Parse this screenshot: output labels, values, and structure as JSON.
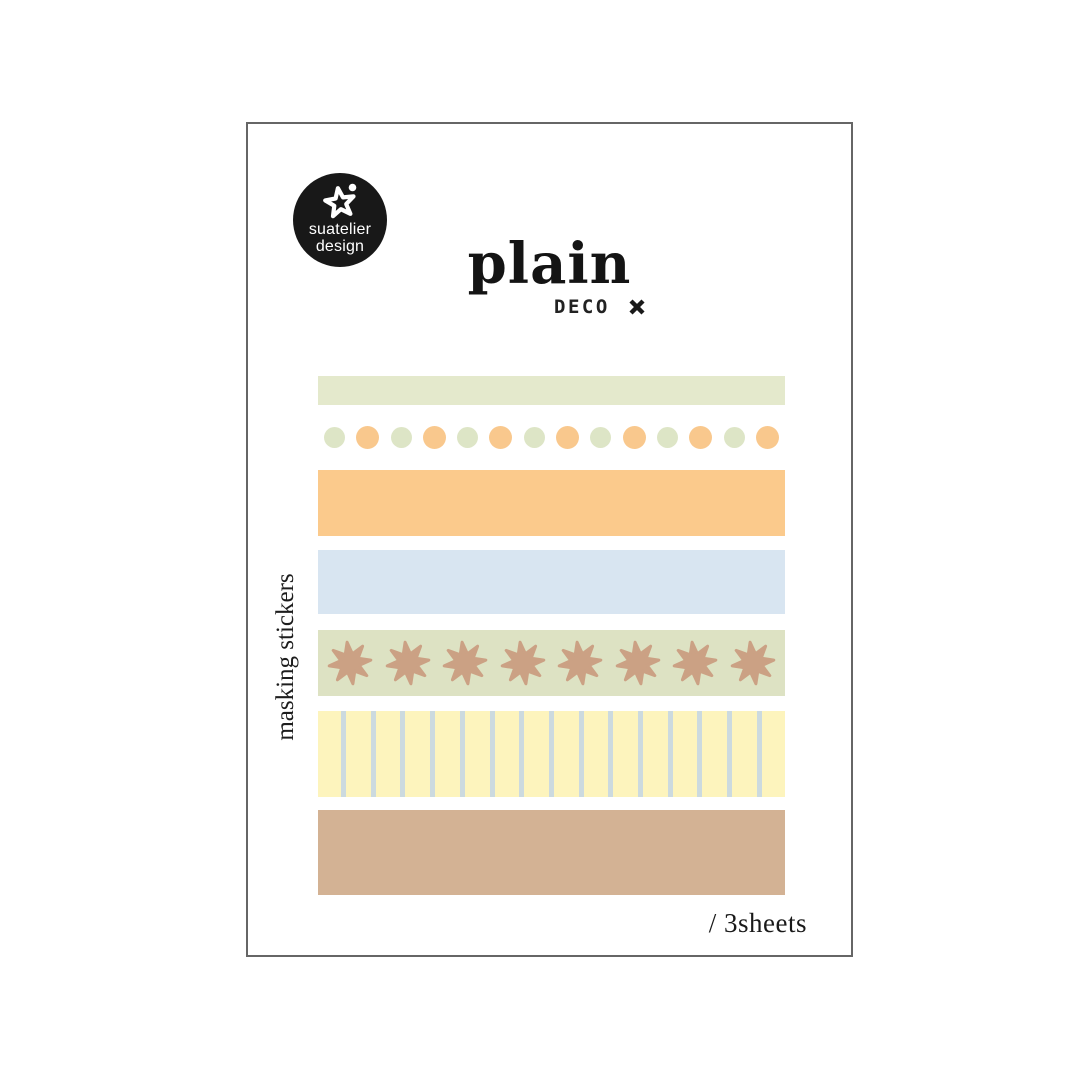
{
  "background": "#ffffff",
  "card": {
    "border_color": "#666666",
    "background": "#ffffff"
  },
  "logo": {
    "line1": "suatelier",
    "line2": "design",
    "background": "#181818",
    "text_color": "#ffffff",
    "icon": "star-doodle-icon"
  },
  "title": {
    "main": "plain",
    "sub": "DECO",
    "mark": "x-mark",
    "color": "#141414"
  },
  "side_label": "masking stickers",
  "footer": {
    "sheets": "/ 3sheets"
  },
  "strips": [
    {
      "name": "tape-sage",
      "type": "solid",
      "color": "#e4e9cc",
      "top": 252,
      "height": 29
    },
    {
      "name": "tape-dots",
      "type": "dots",
      "top": 302,
      "height": 23,
      "dot_count": 14,
      "dot_colors": [
        "#dde5c6",
        "#f9c88d"
      ],
      "dot_sizes": [
        21,
        23
      ]
    },
    {
      "name": "tape-orange",
      "type": "solid",
      "color": "#fbca8c",
      "top": 346,
      "height": 66
    },
    {
      "name": "tape-blue",
      "type": "solid",
      "color": "#d8e5f1",
      "top": 426,
      "height": 64
    },
    {
      "name": "tape-stars",
      "type": "stars",
      "color": "#dde2c3",
      "star_color": "#cba184",
      "star_count": 8,
      "top": 506,
      "height": 66
    },
    {
      "name": "tape-stripes",
      "type": "stripes",
      "color": "#fdf4bd",
      "line_color": "#ccdadf",
      "line_count": 15,
      "line_width": 5,
      "line_gap": 29.7,
      "line_offset": 23,
      "top": 587,
      "height": 86
    },
    {
      "name": "tape-tan",
      "type": "solid",
      "color": "#d3b294",
      "top": 686,
      "height": 85
    }
  ]
}
